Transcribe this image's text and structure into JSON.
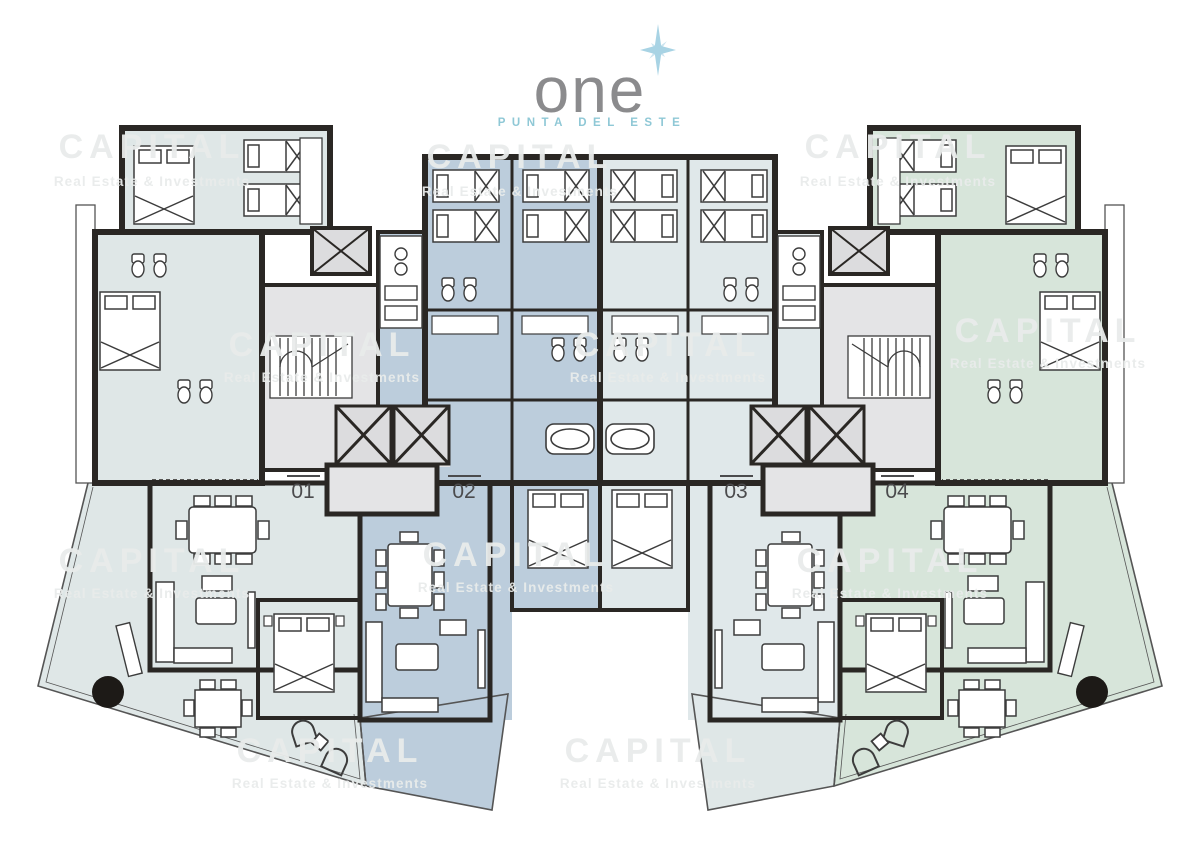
{
  "logo": {
    "wordmark": "one",
    "subtitle": "PUNTA DEL ESTE",
    "wordmark_color": "#8b8b8d",
    "subtitle_color": "#8fc8d6",
    "star_color": "#a8d3e4"
  },
  "watermark": {
    "title": "CAPITAL",
    "subtitle": "Real Estate & Investments",
    "color": "#e9eceb"
  },
  "units": [
    {
      "id": "01",
      "tint": "#dfe7e7"
    },
    {
      "id": "02",
      "tint": "#bccddc"
    },
    {
      "id": "03",
      "tint": "#dfe7e7"
    },
    {
      "id": "04",
      "tint": "#d7e5da"
    }
  ],
  "colors": {
    "wall": "#2a2724",
    "furniture_line": "#3c3c3c",
    "tint_light": "#dfe7e7",
    "tint_blue": "#bccddc",
    "tint_green": "#d7e5da",
    "tint_gray": "#e4e4e6",
    "elevator_gray": "#dcdcde",
    "terrace_edge": "#555555",
    "dark_circle": "#1d1a17",
    "label_text": "#4b4b4d",
    "background": "#ffffff"
  }
}
